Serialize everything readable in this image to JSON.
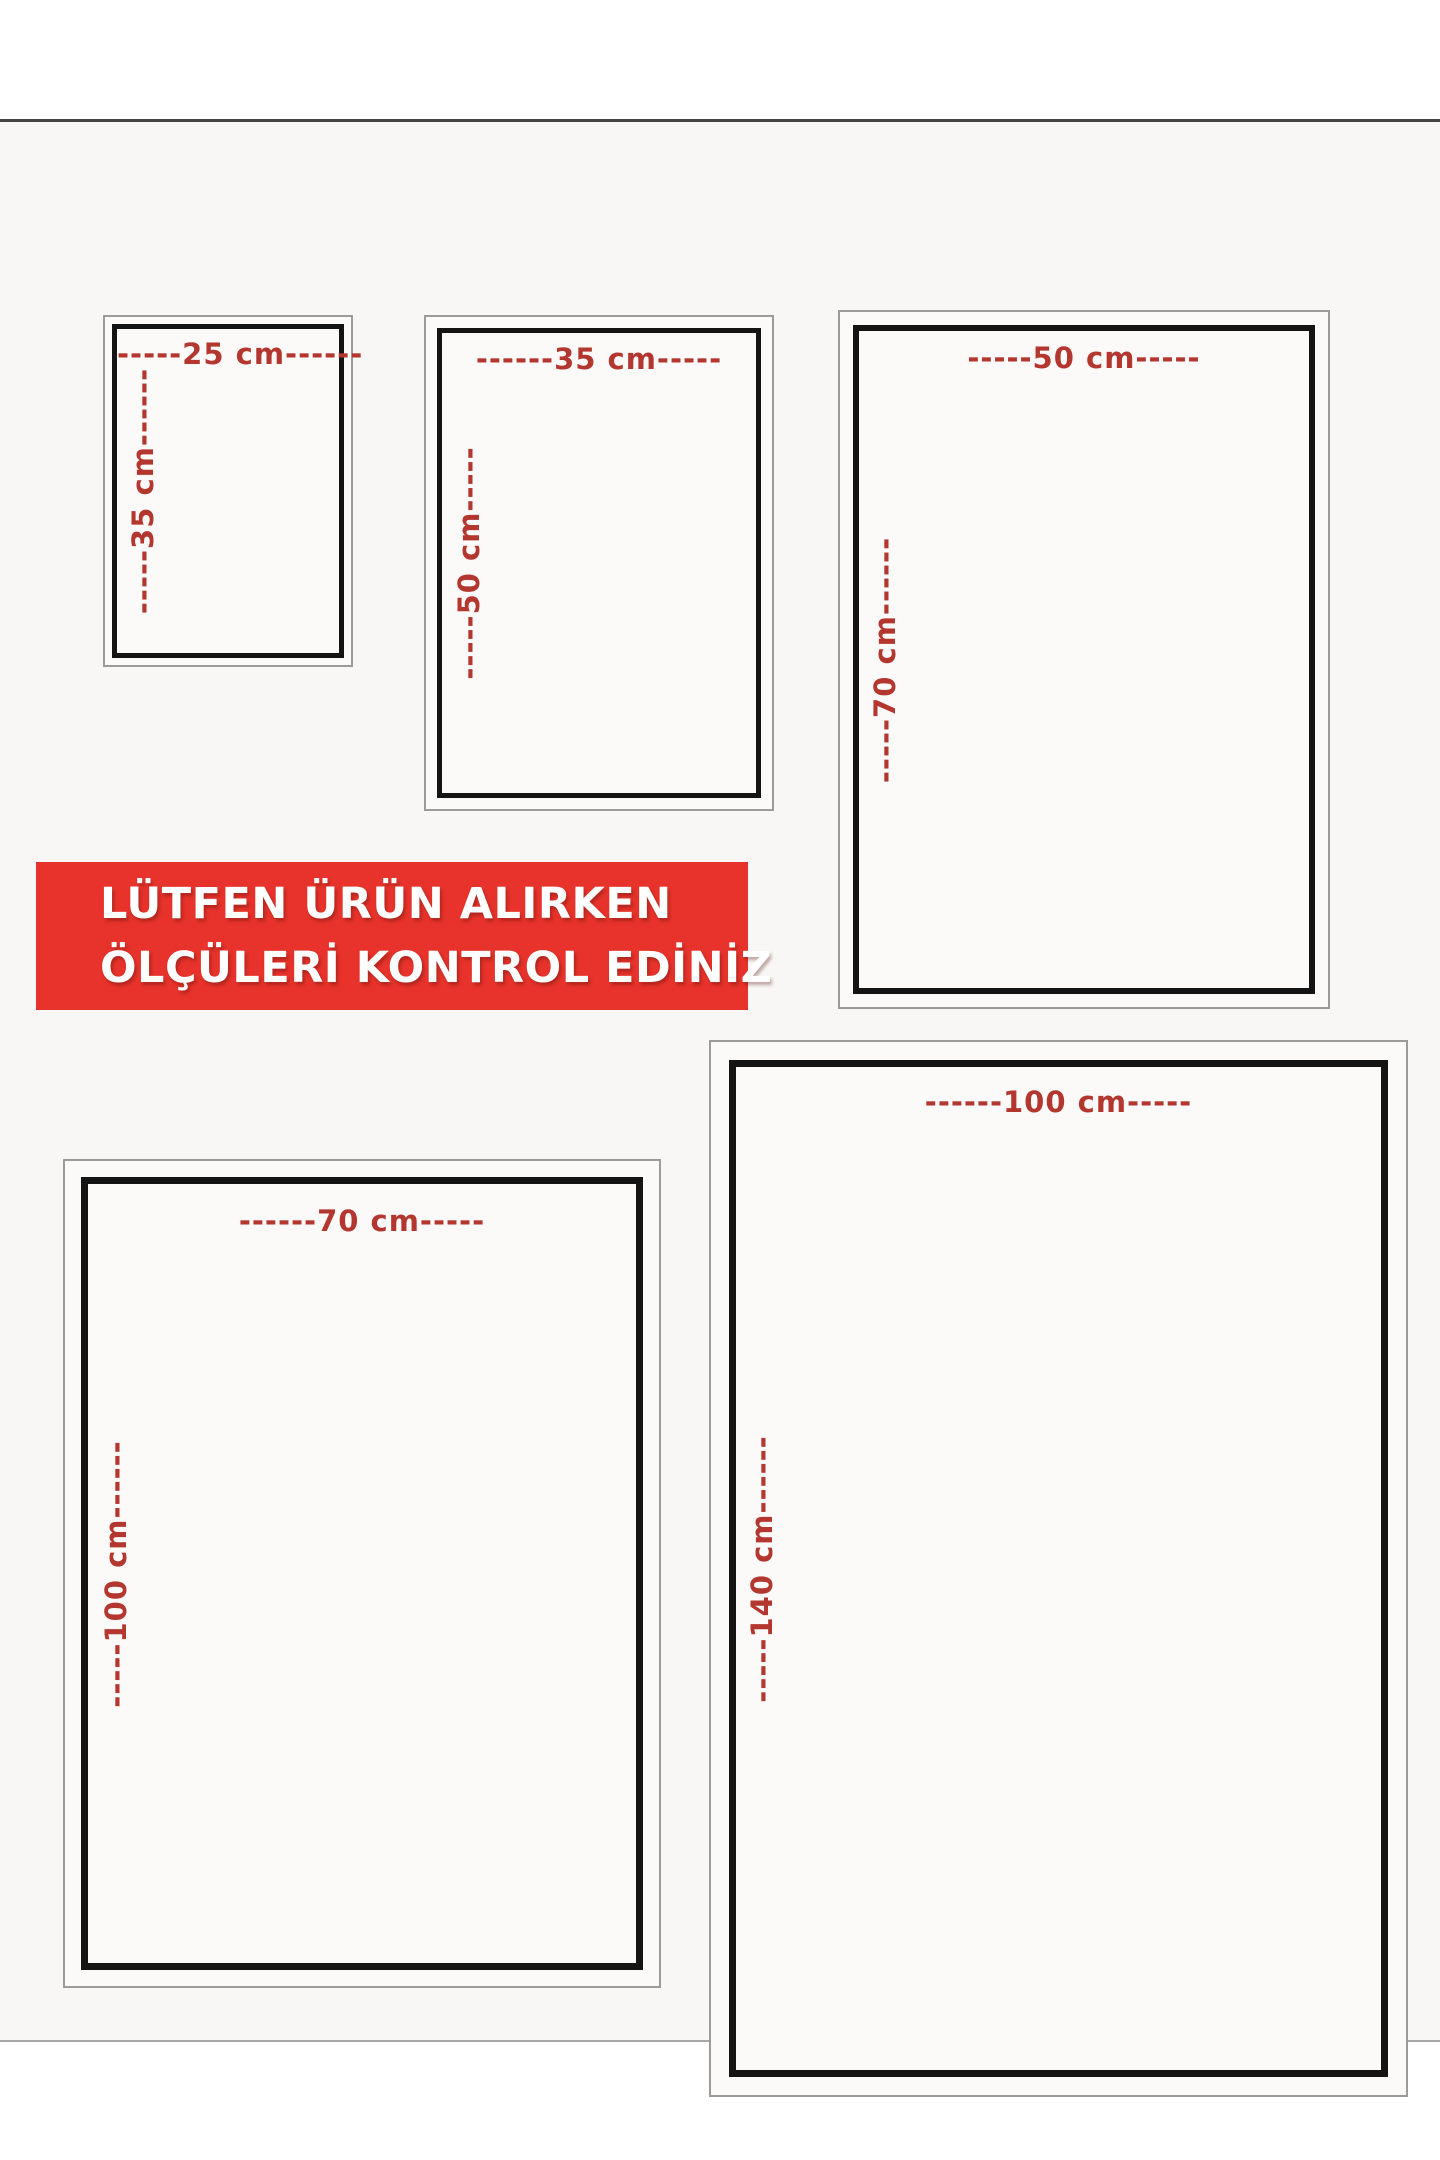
{
  "notice_banner": {
    "line1": "LÜTFEN ÜRÜN ALIRKEN",
    "line2": "ÖLÇÜLERİ KONTROL EDİNİZ",
    "background_color": "#E7332B",
    "text_color": "#FFFFFF"
  },
  "label_color": "#B3362F",
  "size_boxes": [
    {
      "name": "25x35 cm",
      "width_label": "-----25 cm------",
      "height_label": "-----35 cm------"
    },
    {
      "name": "35x50 cm",
      "width_label": "------35 cm-----",
      "height_label": "-----50 cm-----"
    },
    {
      "name": "50x70 cm",
      "width_label": "-----50 cm-----",
      "height_label": "-----70 cm------"
    },
    {
      "name": "70x100 cm",
      "width_label": "------70 cm-----",
      "height_label": "-----100 cm------"
    },
    {
      "name": "100x140 cm",
      "width_label": "------100 cm-----",
      "height_label": "-----140 cm------"
    }
  ]
}
